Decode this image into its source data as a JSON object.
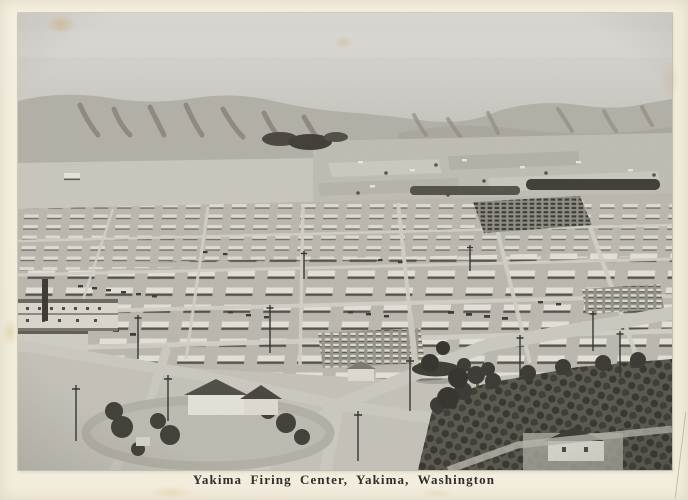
{
  "postcard": {
    "caption": "Yakima Firing Center, Yakima, Washington",
    "photo_description": "Black-and-white aerial photograph of the Yakima Firing Center cantonment: a large grid of long white barracks buildings and parked military vehicles on a desert plain, bare eroded hills and irrigated farmland with tree windbreaks in the distance, and houses, shade trees, a loop driveway and an orchard in the foreground.",
    "colors": {
      "paper": "#f2ecdc",
      "sky": "#d3d1cb",
      "hills": "#b2afa6",
      "plain": "#c4c1b8",
      "camp_ground": "#bab7ae",
      "barracks_roof": "#e1ded5",
      "shadow_dark": "#3b3933",
      "caption_ink": "#2f2e29"
    }
  }
}
